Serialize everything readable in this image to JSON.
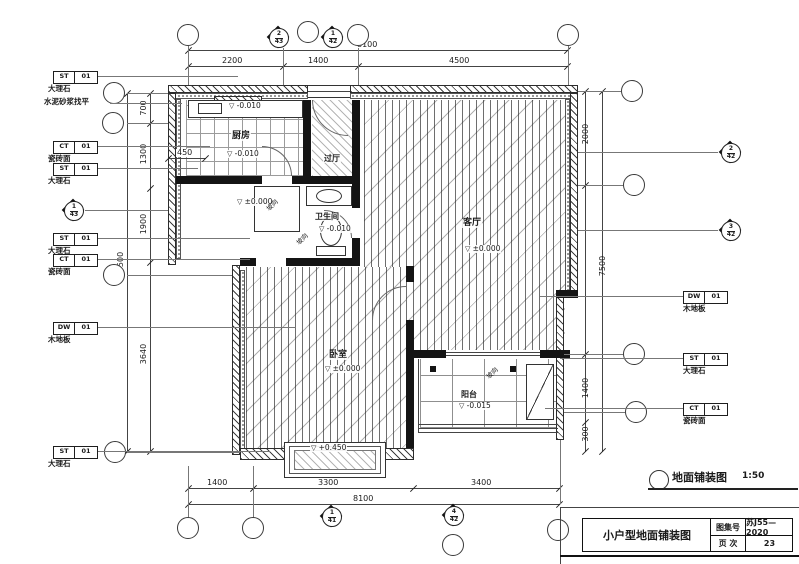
{
  "sheet": {
    "caption_title": "地面铺装图",
    "caption_scale": "1:50"
  },
  "title_block": {
    "title": "小户型地面铺装图",
    "atlas_label": "图集号",
    "atlas_value": "苏J55—2020",
    "page_label": "页 次",
    "page_value": "23"
  },
  "rooms": {
    "kitchen": {
      "name": "厨房",
      "level": "-0.010"
    },
    "hall": {
      "name": "过厅"
    },
    "bath": {
      "name": "卫生间",
      "level": "-0.010"
    },
    "living": {
      "name": "客厅",
      "level": "±0.000"
    },
    "bedroom": {
      "name": "卧室",
      "level": "±0.000"
    },
    "balcony": {
      "name": "阳台",
      "level": "-0.015"
    }
  },
  "levels": {
    "kitchen_window": "-0.010",
    "entry": "±0.000",
    "bay_window": "+0.450"
  },
  "notes": {
    "leveling": "水泥砂浆找平",
    "slope": "坡向"
  },
  "finish_tags": {
    "left": [
      {
        "code": "ST",
        "num": "01",
        "label": "大理石"
      },
      {
        "code": "CT",
        "num": "01",
        "label": "瓷砖面"
      },
      {
        "code": "ST",
        "num": "01",
        "label": "大理石"
      },
      {
        "code": "ST",
        "num": "01",
        "label": "大理石"
      },
      {
        "code": "CT",
        "num": "01",
        "label": "瓷砖面"
      },
      {
        "code": "DW",
        "num": "01",
        "label": "木地板"
      },
      {
        "code": "ST",
        "num": "01",
        "label": "大理石"
      }
    ],
    "right": [
      {
        "code": "DW",
        "num": "01",
        "label": "木地板"
      },
      {
        "code": "ST",
        "num": "01",
        "label": "大理石"
      },
      {
        "code": "CT",
        "num": "01",
        "label": "瓷砖面"
      }
    ]
  },
  "dims": {
    "top_total": "8100",
    "top": [
      "2200",
      "1400",
      "4500"
    ],
    "bottom": [
      "1400",
      "3300",
      "3400"
    ],
    "bottom_total": "8100",
    "left": [
      "700",
      "1300",
      "1900",
      "3640"
    ],
    "left_total": "7500",
    "right": [
      "2000",
      "1400",
      "300"
    ],
    "right_total": "7500",
    "kitchen_recess": "450"
  },
  "markers": {
    "top_a": {
      "n": "2",
      "d": "43"
    },
    "top_b": {
      "n": "1",
      "d": "42"
    },
    "left_a": {
      "n": "1",
      "d": "43"
    },
    "right_a": {
      "n": "2",
      "d": "42"
    },
    "right_b": {
      "n": "3",
      "d": "42"
    },
    "bottom_a": {
      "n": "1",
      "d": "41"
    },
    "bottom_b": {
      "n": "4",
      "d": "42"
    }
  }
}
